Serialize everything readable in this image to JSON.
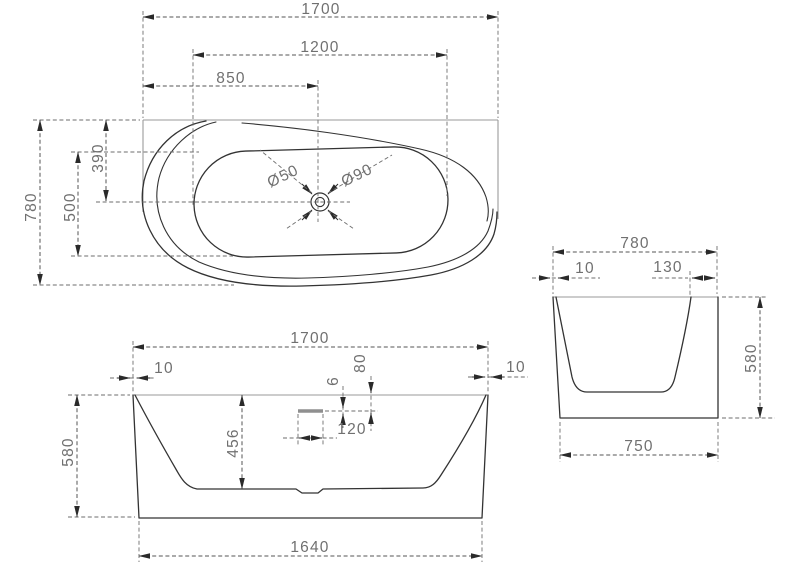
{
  "colors": {
    "outline": "#333333",
    "light_line": "#9a9a9a",
    "dimension_line": "#555555",
    "extension_line": "#6e6e6e",
    "arrow": "#2a2a2a",
    "text": "#707070",
    "overflow_slot": "#8f8f8f",
    "background": "#ffffff"
  },
  "top_view": {
    "overall_length": "1700",
    "basin_length": "1200",
    "drain_offset_from_left": "850",
    "overall_width": "780",
    "basin_width": "500",
    "drain_offset_from_back": "390",
    "drain_diameter": "Ø50",
    "drain_recess_diameter": "Ø90"
  },
  "front_view": {
    "overall_length": "1700",
    "rim_thickness_left": "10",
    "rim_thickness_right": "10",
    "overall_height": "580",
    "basin_depth": "456",
    "overflow_slot_height": "6",
    "overflow_below_rim": "80",
    "overflow_width": "120",
    "base_length": "1640"
  },
  "side_view": {
    "overall_width": "780",
    "rim_thickness_left": "10",
    "deck_width_right": "130",
    "overall_height": "580",
    "base_width": "750"
  }
}
